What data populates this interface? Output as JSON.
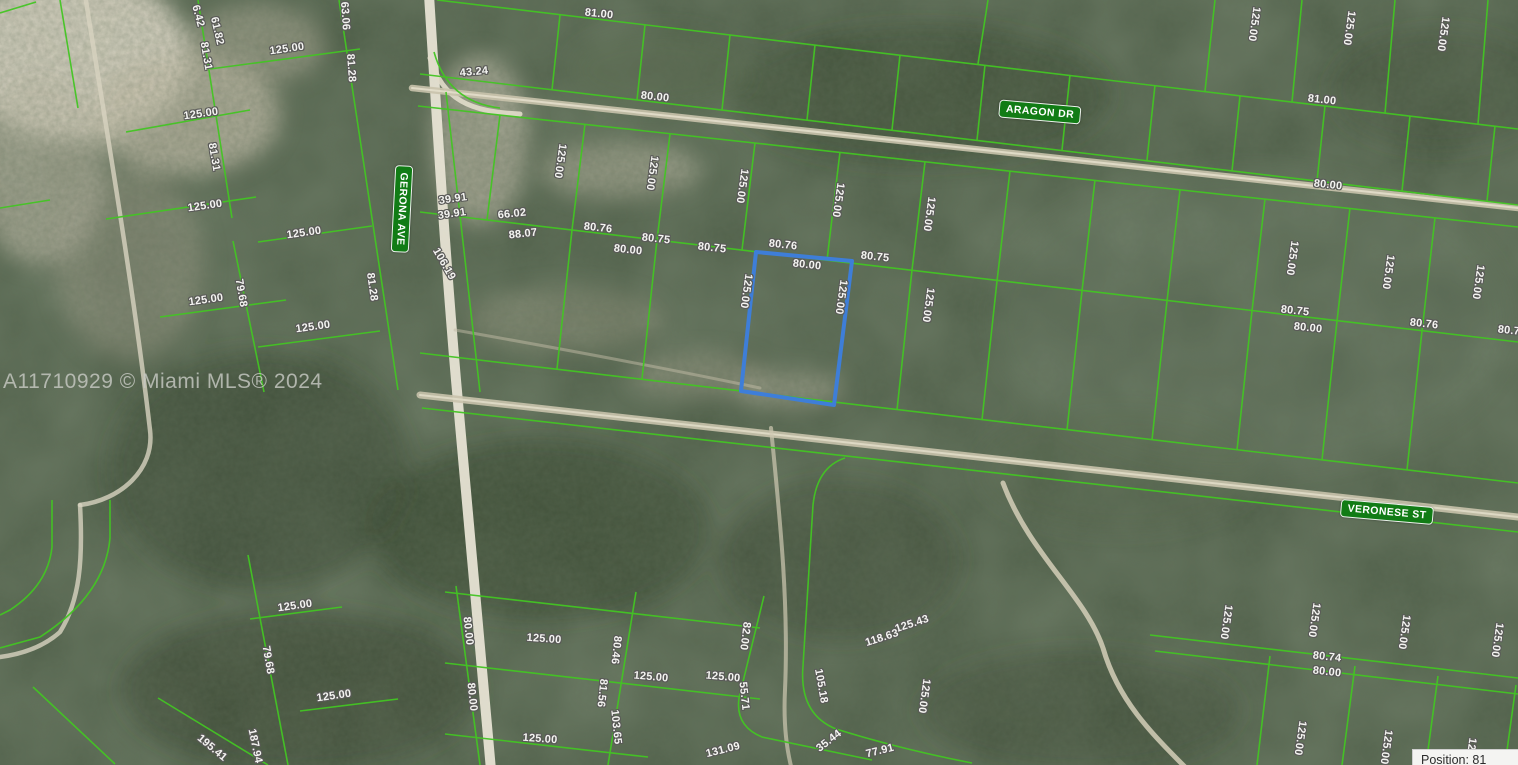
{
  "map": {
    "watermark": "A11710929 © Miami MLS® 2024",
    "position_indicator": "Position: 81",
    "colors": {
      "parcel_line_green": "#43c523",
      "street_badge_green": "#117c15",
      "subject_parcel_blue": "#3e7ed8",
      "label_text": "#f4f4f1",
      "road_sand": "#d6d0bb",
      "terrain_base": "#4d5d47"
    },
    "streets": [
      {
        "name": "ARAGON DR",
        "x": 1040,
        "y": 112,
        "r": 5
      },
      {
        "name": "GERONA AVE",
        "x": 402,
        "y": 209,
        "r": 93
      },
      {
        "name": "VERONESE ST",
        "x": 1387,
        "y": 512,
        "r": 5
      }
    ],
    "subject_parcel": {
      "outline_color": "#3e7ed8",
      "frontage_label": "80.00",
      "depth_label": "125.00"
    },
    "dimension_labels": [
      {
        "t": "6.42",
        "x": 198,
        "y": 16,
        "r": 75
      },
      {
        "t": "61.82",
        "x": 217,
        "y": 31,
        "r": 77
      },
      {
        "t": "81.31",
        "x": 206,
        "y": 56,
        "r": 80
      },
      {
        "t": "63.06",
        "x": 345,
        "y": 16,
        "r": 86
      },
      {
        "t": "81.28",
        "x": 351,
        "y": 68,
        "r": 86
      },
      {
        "t": "125.00",
        "x": 287,
        "y": 49,
        "r": -8
      },
      {
        "t": "125.00",
        "x": 201,
        "y": 114,
        "r": -8
      },
      {
        "t": "81.31",
        "x": 214,
        "y": 157,
        "r": 80
      },
      {
        "t": "125.00",
        "x": 205,
        "y": 206,
        "r": -8
      },
      {
        "t": "125.00",
        "x": 304,
        "y": 233,
        "r": -8
      },
      {
        "t": "125.00",
        "x": 206,
        "y": 300,
        "r": -8
      },
      {
        "t": "79.68",
        "x": 241,
        "y": 293,
        "r": 80
      },
      {
        "t": "81.28",
        "x": 372,
        "y": 287,
        "r": 82
      },
      {
        "t": "106.19",
        "x": 444,
        "y": 264,
        "r": 60
      },
      {
        "t": "125.00",
        "x": 313,
        "y": 327,
        "r": -8
      },
      {
        "t": "125.00",
        "x": 295,
        "y": 606,
        "r": -8
      },
      {
        "t": "79.68",
        "x": 268,
        "y": 660,
        "r": 80
      },
      {
        "t": "125.00",
        "x": 334,
        "y": 696,
        "r": -8
      },
      {
        "t": "195.41",
        "x": 212,
        "y": 748,
        "r": 40
      },
      {
        "t": "187.94",
        "x": 255,
        "y": 746,
        "r": 78
      },
      {
        "t": "43.24",
        "x": 474,
        "y": 72,
        "r": -5
      },
      {
        "t": "39.91",
        "x": 453,
        "y": 199,
        "r": -8
      },
      {
        "t": "39.91",
        "x": 452,
        "y": 214,
        "r": -8
      },
      {
        "t": "81.00",
        "x": 599,
        "y": 14,
        "r": 6
      },
      {
        "t": "80.00",
        "x": 655,
        "y": 97,
        "r": 6
      },
      {
        "t": "81.00",
        "x": 1322,
        "y": 100,
        "r": 6
      },
      {
        "t": "80.00",
        "x": 1328,
        "y": 185,
        "r": 6
      },
      {
        "t": "125.00",
        "x": 1254,
        "y": 24,
        "r": 98
      },
      {
        "t": "125.00",
        "x": 1349,
        "y": 28,
        "r": 98
      },
      {
        "t": "125.00",
        "x": 1443,
        "y": 34,
        "r": 98
      },
      {
        "t": "125.00",
        "x": 560,
        "y": 161,
        "r": 98
      },
      {
        "t": "125.00",
        "x": 652,
        "y": 173,
        "r": 98
      },
      {
        "t": "125.00",
        "x": 742,
        "y": 186,
        "r": 98
      },
      {
        "t": "125.00",
        "x": 838,
        "y": 200,
        "r": 98
      },
      {
        "t": "125.00",
        "x": 929,
        "y": 214,
        "r": 98
      },
      {
        "t": "125.00",
        "x": 1292,
        "y": 258,
        "r": 98
      },
      {
        "t": "125.00",
        "x": 1388,
        "y": 272,
        "r": 98
      },
      {
        "t": "125.00",
        "x": 1478,
        "y": 282,
        "r": 98
      },
      {
        "t": "66.02",
        "x": 512,
        "y": 214,
        "r": -6
      },
      {
        "t": "88.07",
        "x": 523,
        "y": 234,
        "r": -6
      },
      {
        "t": "80.76",
        "x": 598,
        "y": 228,
        "r": 6
      },
      {
        "t": "80.00",
        "x": 628,
        "y": 250,
        "r": 6
      },
      {
        "t": "80.75",
        "x": 656,
        "y": 239,
        "r": 6
      },
      {
        "t": "80.75",
        "x": 712,
        "y": 248,
        "r": 6
      },
      {
        "t": "80.76",
        "x": 783,
        "y": 245,
        "r": 6
      },
      {
        "t": "80.00",
        "x": 807,
        "y": 265,
        "r": 6
      },
      {
        "t": "80.75",
        "x": 875,
        "y": 257,
        "r": 6
      },
      {
        "t": "80.75",
        "x": 1295,
        "y": 311,
        "r": 6
      },
      {
        "t": "80.00",
        "x": 1308,
        "y": 328,
        "r": 6
      },
      {
        "t": "80.76",
        "x": 1424,
        "y": 324,
        "r": 6
      },
      {
        "t": "80.75",
        "x": 1512,
        "y": 331,
        "r": 6
      },
      {
        "t": "125.00",
        "x": 746,
        "y": 291,
        "r": 98
      },
      {
        "t": "125.00",
        "x": 841,
        "y": 297,
        "r": 98
      },
      {
        "t": "125.00",
        "x": 928,
        "y": 305,
        "r": 98
      },
      {
        "t": "125.00",
        "x": 1226,
        "y": 622,
        "r": 98
      },
      {
        "t": "125.00",
        "x": 1314,
        "y": 620,
        "r": 98
      },
      {
        "t": "125.00",
        "x": 1404,
        "y": 632,
        "r": 98
      },
      {
        "t": "125.00",
        "x": 1497,
        "y": 640,
        "r": 98
      },
      {
        "t": "80.74",
        "x": 1327,
        "y": 657,
        "r": 6
      },
      {
        "t": "80.00",
        "x": 1327,
        "y": 672,
        "r": 6
      },
      {
        "t": "125.00",
        "x": 1300,
        "y": 738,
        "r": 98
      },
      {
        "t": "125.00",
        "x": 1386,
        "y": 747,
        "r": 98
      },
      {
        "t": "125.00",
        "x": 1470,
        "y": 755,
        "r": 98
      },
      {
        "t": "80.00",
        "x": 468,
        "y": 631,
        "r": 84
      },
      {
        "t": "80.00",
        "x": 472,
        "y": 697,
        "r": 84
      },
      {
        "t": "125.00",
        "x": 544,
        "y": 639,
        "r": 4
      },
      {
        "t": "125.00",
        "x": 540,
        "y": 739,
        "r": 4
      },
      {
        "t": "80.46",
        "x": 616,
        "y": 650,
        "r": 96
      },
      {
        "t": "81.56",
        "x": 602,
        "y": 693,
        "r": 96
      },
      {
        "t": "103.65",
        "x": 616,
        "y": 727,
        "r": 84
      },
      {
        "t": "125.00",
        "x": 651,
        "y": 677,
        "r": 5
      },
      {
        "t": "125.00",
        "x": 723,
        "y": 677,
        "r": 5
      },
      {
        "t": "82.00",
        "x": 745,
        "y": 636,
        "r": 97
      },
      {
        "t": "55.71",
        "x": 744,
        "y": 696,
        "r": 84
      },
      {
        "t": "131.09",
        "x": 723,
        "y": 750,
        "r": -14
      },
      {
        "t": "105.18",
        "x": 821,
        "y": 686,
        "r": 80
      },
      {
        "t": "125.43",
        "x": 912,
        "y": 624,
        "r": -18
      },
      {
        "t": "118.63",
        "x": 882,
        "y": 638,
        "r": -18
      },
      {
        "t": "35.44",
        "x": 829,
        "y": 741,
        "r": -38
      },
      {
        "t": "77.91",
        "x": 880,
        "y": 751,
        "r": -14
      },
      {
        "t": "125.00",
        "x": 924,
        "y": 696,
        "r": 98
      }
    ]
  }
}
